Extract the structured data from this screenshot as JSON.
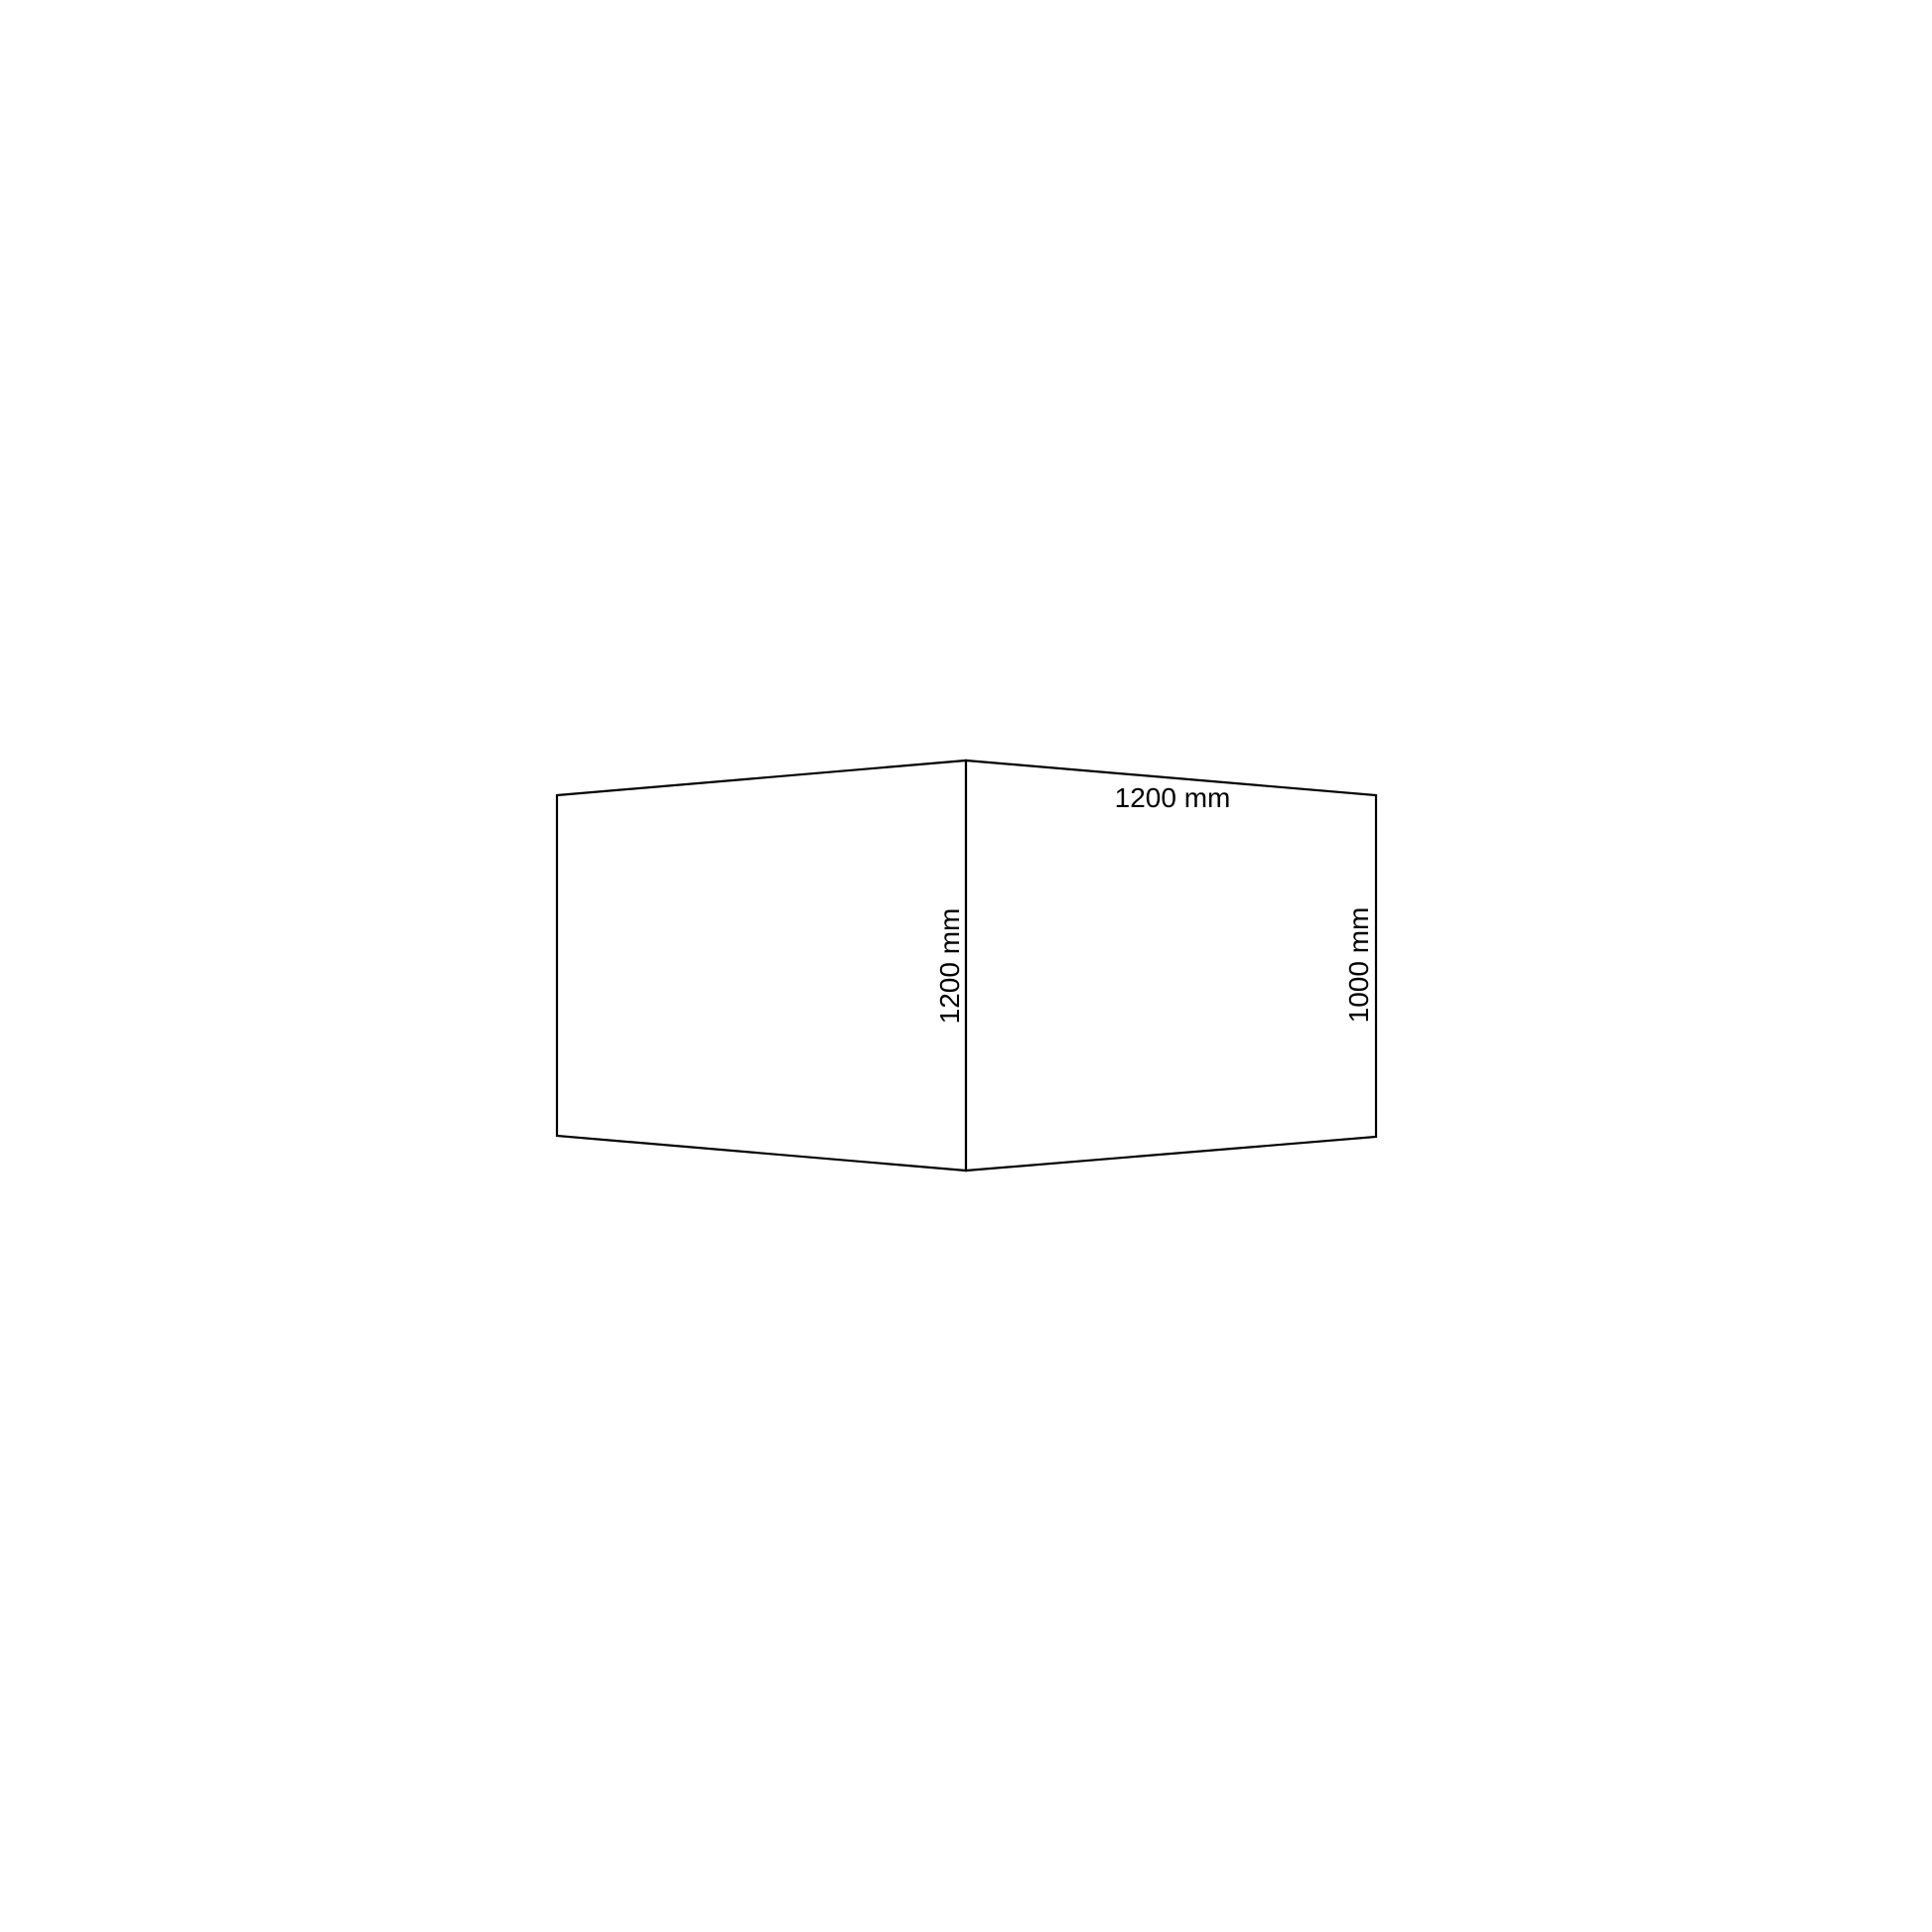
{
  "page": {
    "background_color": "#ffffff"
  },
  "diagram": {
    "description": "isometric corner view of two joined rectangular panels with dimension annotations",
    "line_color": "#000000",
    "text_color": "#000000",
    "face_fill": "#ffffff",
    "labels": {
      "top_width": "1200 mm",
      "center_depth": "1200 mm",
      "right_height": "1000 mm"
    }
  }
}
